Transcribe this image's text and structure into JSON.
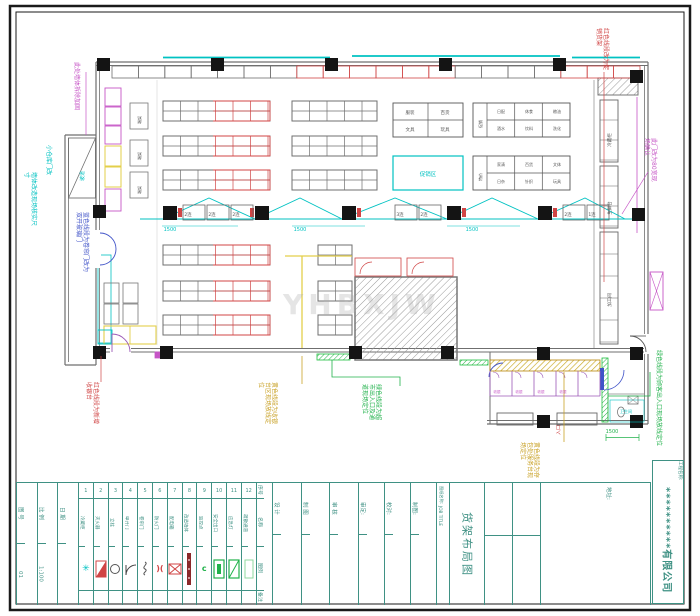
{
  "palette": {
    "red": "#d04545",
    "cyan": "#00c2c2",
    "green": "#21b24b",
    "magenta": "#c655c6",
    "olive": "#c9a227",
    "navy": "#4053c8",
    "teal": "#3f9184",
    "wall": "#6f6f6f",
    "dark": "#141414",
    "yellow": "#e3cf4a",
    "purple": "#9b59b6",
    "hatch": "#9a9a9a"
  },
  "watermark": "YHBXJW",
  "title_block": {
    "info_cols": [
      {
        "label": "图 号",
        "value": "01"
      },
      {
        "label": "比 例",
        "value": "1:100"
      },
      {
        "label": "日 期",
        "value": ""
      }
    ],
    "legend": {
      "headers": [
        "序号",
        "名称",
        "图例",
        "备注"
      ],
      "items": [
        {
          "no": "1",
          "name": "冷藏柜",
          "sym": "snow"
        },
        {
          "no": "2",
          "name": "灭火器",
          "sym": "tri"
        },
        {
          "no": "3",
          "name": "立柱",
          "sym": "circ"
        },
        {
          "no": "4",
          "name": "单开门",
          "sym": "door"
        },
        {
          "no": "5",
          "name": "卷帘门",
          "sym": "coil"
        },
        {
          "no": "6",
          "name": "防火门",
          "sym": "fire"
        },
        {
          "no": "7",
          "name": "配电箱",
          "sym": "boxx"
        },
        {
          "no": "8",
          "name": "改造墙体",
          "sym": "bar"
        },
        {
          "no": "9",
          "name": "监控点",
          "sym": "cam"
        },
        {
          "no": "10",
          "name": "安全出口",
          "sym": "exit"
        },
        {
          "no": "11",
          "name": "应急灯",
          "sym": "lamp"
        },
        {
          "no": "12",
          "name": "疏散通道",
          "sym": "pass"
        }
      ]
    },
    "sign_cols": [
      "设 计",
      "制 图",
      "审 核"
    ],
    "approve_cols": [
      "审定:",
      "校对:",
      "制图:"
    ],
    "drawing_name_label": "图纸名称:",
    "job_title_label": "JOB TITLE",
    "drawing_title": "货架布局图",
    "address_label": "地址:",
    "project_label": "工程名称:",
    "company": "**********有限公司"
  },
  "annotations": [
    {
      "text": "此处墙体拆除加固",
      "x": 72,
      "y": 62,
      "h": 62,
      "color": "magenta"
    },
    {
      "text": "小仓库门改",
      "x": 44,
      "y": 145,
      "h": 42,
      "color": "cyan"
    },
    {
      "text": "墙体改造现场核实尺寸",
      "x": 22,
      "y": 172,
      "h": 58,
      "color": "cyan"
    },
    {
      "text": "蓝色线段为卷帘门改为双开玻璃门",
      "x": 74,
      "y": 212,
      "h": 60,
      "color": "navy"
    },
    {
      "text": "红色线段为新增收银台",
      "x": 84,
      "y": 382,
      "h": 44,
      "color": "red"
    },
    {
      "text": "黄色线段为收银台区现场放线定位",
      "x": 256,
      "y": 382,
      "h": 44,
      "color": "olive"
    },
    {
      "text": "绿色线段为超市出入口及通道现场定位",
      "x": 360,
      "y": 384,
      "h": 36,
      "color": "green"
    },
    {
      "text": "红色线段改为促销货架",
      "x": 594,
      "y": 28,
      "h": 46,
      "color": "red"
    },
    {
      "text": "此门改为80宽现场确认",
      "x": 642,
      "y": 138,
      "h": 48,
      "color": "magenta"
    },
    {
      "text": "绿色线段为顾客出入口现场放线定位",
      "x": 654,
      "y": 350,
      "h": 100,
      "color": "green"
    },
    {
      "text": "黄色线段为存包处服务台现场定位",
      "x": 518,
      "y": 442,
      "h": 38,
      "color": "olive"
    }
  ],
  "plan_labels": [
    {
      "t": "1500",
      "x": 170,
      "y": 231,
      "c": "cyan",
      "fs": 5
    },
    {
      "t": "1500",
      "x": 300,
      "y": 231,
      "c": "cyan",
      "fs": 5
    },
    {
      "t": "1500",
      "x": 472,
      "y": 231,
      "c": "cyan",
      "fs": 5
    },
    {
      "t": "1500",
      "x": 612,
      "y": 433,
      "c": "green",
      "fs": 5
    },
    {
      "t": "2连",
      "x": 188,
      "y": 216,
      "fs": 4.5
    },
    {
      "t": "2连",
      "x": 212,
      "y": 216,
      "fs": 4.5
    },
    {
      "t": "2连",
      "x": 236,
      "y": 216,
      "fs": 4.5
    },
    {
      "t": "3连",
      "x": 400,
      "y": 216,
      "fs": 4.5
    },
    {
      "t": "2连",
      "x": 424,
      "y": 216,
      "fs": 4.5
    },
    {
      "t": "2连",
      "x": 568,
      "y": 216,
      "fs": 4.5
    },
    {
      "t": "1连",
      "x": 592,
      "y": 216,
      "fs": 4.5
    },
    {
      "t": "服装",
      "x": 410,
      "y": 114,
      "fs": 4.5
    },
    {
      "t": "百货",
      "x": 445,
      "y": 114,
      "fs": 4.5
    },
    {
      "t": "文具",
      "x": 410,
      "y": 131,
      "fs": 4.5
    },
    {
      "t": "玩具",
      "x": 445,
      "y": 131,
      "fs": 4.5
    },
    {
      "t": "日配",
      "x": 501,
      "y": 113,
      "fs": 4
    },
    {
      "t": "休食",
      "x": 529,
      "y": 113,
      "fs": 4
    },
    {
      "t": "粮油",
      "x": 557,
      "y": 113,
      "fs": 4
    },
    {
      "t": "酒水",
      "x": 501,
      "y": 130,
      "fs": 4
    },
    {
      "t": "饮料",
      "x": 529,
      "y": 130,
      "fs": 4
    },
    {
      "t": "洗化",
      "x": 557,
      "y": 130,
      "fs": 4
    },
    {
      "t": "家清",
      "x": 501,
      "y": 166,
      "fs": 4
    },
    {
      "t": "百货",
      "x": 529,
      "y": 166,
      "fs": 4
    },
    {
      "t": "文体",
      "x": 557,
      "y": 166,
      "fs": 4
    },
    {
      "t": "日杂",
      "x": 501,
      "y": 183,
      "fs": 4
    },
    {
      "t": "针织",
      "x": 529,
      "y": 183,
      "fs": 4
    },
    {
      "t": "玩具",
      "x": 557,
      "y": 183,
      "fs": 4
    },
    {
      "t": "促销",
      "x": 482,
      "y": 124,
      "rot": -90,
      "fs": 4
    },
    {
      "t": "特价",
      "x": 482,
      "y": 177,
      "rot": -90,
      "fs": 4
    },
    {
      "t": "促销区",
      "x": 428,
      "y": 176,
      "c": "cyan",
      "fs": 5.5
    },
    {
      "t": "冷藏柜",
      "x": 611,
      "y": 140,
      "rot": -90,
      "fs": 4.5
    },
    {
      "t": "生鲜台",
      "x": 611,
      "y": 208,
      "rot": -90,
      "fs": 4.5
    },
    {
      "t": "加工间",
      "x": 611,
      "y": 300,
      "rot": -90,
      "fs": 4.5
    },
    {
      "t": "坡道",
      "x": 84,
      "y": 176,
      "rot": -90,
      "c": "cyan",
      "fs": 5
    },
    {
      "t": "入口",
      "x": 560,
      "y": 430,
      "rot": -90,
      "c": "red",
      "fs": 5
    },
    {
      "t": "收银",
      "x": 497,
      "y": 393,
      "c": "magenta",
      "fs": 3.5
    },
    {
      "t": "收银",
      "x": 519,
      "y": 393,
      "c": "magenta",
      "fs": 3.5
    },
    {
      "t": "收银",
      "x": 541,
      "y": 393,
      "c": "magenta",
      "fs": 3.5
    },
    {
      "t": "收银",
      "x": 563,
      "y": 393,
      "c": "magenta",
      "fs": 3.5
    },
    {
      "t": "端架",
      "x": 141,
      "y": 120,
      "rot": -90,
      "fs": 4
    },
    {
      "t": "端架",
      "x": 141,
      "y": 156,
      "rot": -90,
      "fs": 4
    },
    {
      "t": "端架",
      "x": 141,
      "y": 190,
      "rot": -90,
      "fs": 4
    },
    {
      "t": "卫生间",
      "x": 626,
      "y": 413,
      "c": "cyan",
      "fs": 4
    }
  ]
}
